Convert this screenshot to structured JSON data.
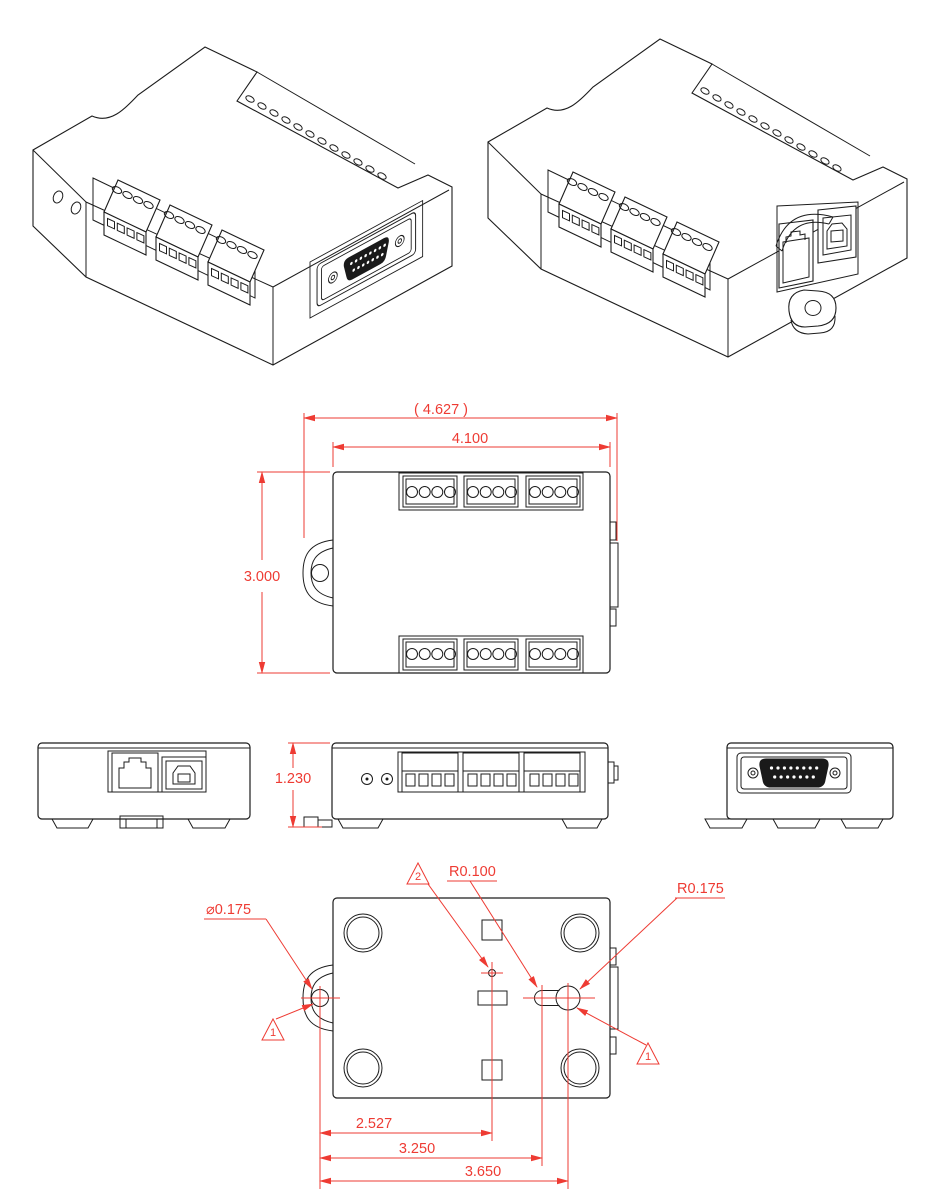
{
  "drawing": {
    "colors": {
      "line": "#1c1c1c",
      "dimension": "#ee3b33",
      "background": "#ffffff"
    },
    "top_view": {
      "dim_overall_width_ref": "( 4.627 )",
      "dim_body_width": "4.100",
      "dim_body_depth": "3.000"
    },
    "side_views": {
      "dim_height": "1.230"
    },
    "bottom_view": {
      "label_tab_hole_diameter": "⌀0.175",
      "label_slot_radius": "R0.100",
      "label_keyhole_radius": "R0.175",
      "dim_tab_to_center_hole": "2.527",
      "dim_tab_to_slot": "3.250",
      "dim_tab_to_keyhole": "3.650",
      "flag_left": "1",
      "flag_center": "2",
      "flag_right": "1"
    }
  }
}
